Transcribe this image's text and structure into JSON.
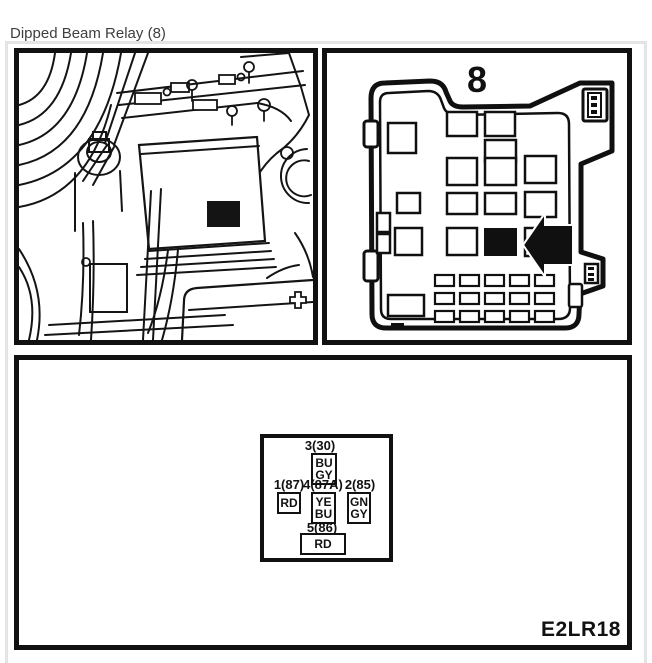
{
  "page": {
    "title": "Dipped Beam Relay (8)"
  },
  "panels": {
    "relay_box": {
      "number_label": "8"
    },
    "pin_diagram": {
      "code": "E2LR18",
      "pin_top": {
        "label": "3(30)",
        "wire": [
          "BU",
          "GY"
        ]
      },
      "pin_left": {
        "label": "1(87)",
        "wire": [
          "RD"
        ]
      },
      "pin_center": {
        "label": "4(87A)",
        "wire": [
          "YE",
          "BU"
        ]
      },
      "pin_right": {
        "label": "2(85)",
        "wire": [
          "GN",
          "GY"
        ]
      },
      "pin_bottom": {
        "label": "5(86)",
        "wire": [
          "RD"
        ]
      }
    }
  }
}
